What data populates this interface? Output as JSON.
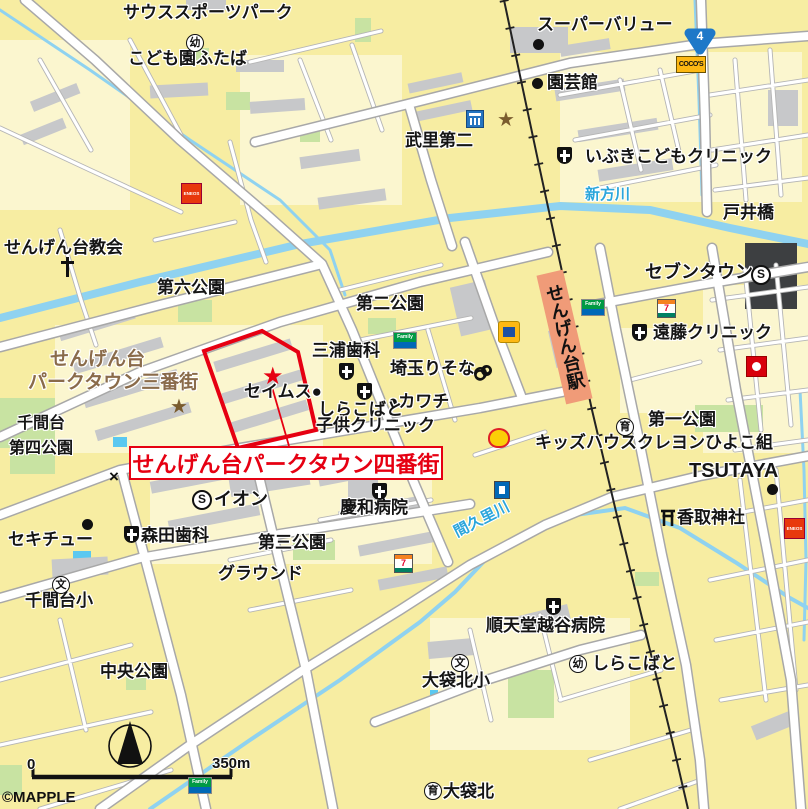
{
  "map": {
    "attribution": "©MAPPLE",
    "scale_bar": {
      "start": "0",
      "end": "350m"
    },
    "route_shield": "4",
    "highlight": {
      "area_label": "せんげん台パークタウン四番街"
    },
    "station": {
      "name": "せんげん台駅"
    },
    "rivers": {
      "shinkata": "新方川",
      "makuri": "間久里川"
    },
    "labels": {
      "south_sports_park": "サウススポーツパーク",
      "kodomoen_futaba": "こども園ふたば",
      "super_value": "スーパーバリュー",
      "engeikan": "園芸館",
      "takesato_daini": "武里第二",
      "ibuki_clinic": "いぶきこどもクリニック",
      "toi_bridge": "戸井橋",
      "sengendai_church": "せんげん台教会",
      "dairoku_park": "第六公園",
      "daini_park": "第二公園",
      "parktown3_l1": "せんげん台",
      "parktown3_l2": "パークタウン三番街",
      "miura_dental": "三浦歯科",
      "saitama_resona": "埼玉りそな",
      "seimusu": "セイムス●",
      "kawachi": "●カワチ",
      "shirakobato_cl_l1": "しらこばと",
      "shirakobato_cl_l2": "子供クリニック",
      "seven_town": "セブンタウン",
      "endo_clinic": "遠藤クリニック",
      "daiichi_park": "第一公園",
      "kids_house": "キッズハウスクレヨンひよこ組",
      "tsutaya": "TSUTAYA",
      "katori_shrine": "香取神社",
      "senmandai_l1": "千間台",
      "senmandai_l2": "第四公園",
      "aeon": "イオン",
      "sekichu": "セキチュー",
      "morita_dental": "森田歯科",
      "daisan_park": "第三公園",
      "keiwa_hospital": "慶和病院",
      "senmandai_elem": "千間台小",
      "ground": "グラウンド",
      "chuo_park": "中央公園",
      "juntendo_hospital": "順天堂越谷病院",
      "obukurokita_elem": "大袋北小",
      "shirakobato": "しらこばと",
      "obukurokita": "大袋北"
    },
    "symbols": {
      "kindergarten": "幼",
      "nursery": "育",
      "school": "文",
      "star": "★",
      "x_mark": "×"
    },
    "brands": {
      "cocos": "COCO'S",
      "eneos": "ENEOS",
      "family": "Family",
      "seven": "7",
      "super_s": "S"
    },
    "colors": {
      "highlight_red": "#E60012",
      "water": "#8FD2F0",
      "park": "#C8E3A2",
      "bg": "#F7EDA2",
      "station_fill": "#F09B78",
      "brown_label": "#8A6B4A",
      "river_label": "#2BA6DB"
    }
  }
}
